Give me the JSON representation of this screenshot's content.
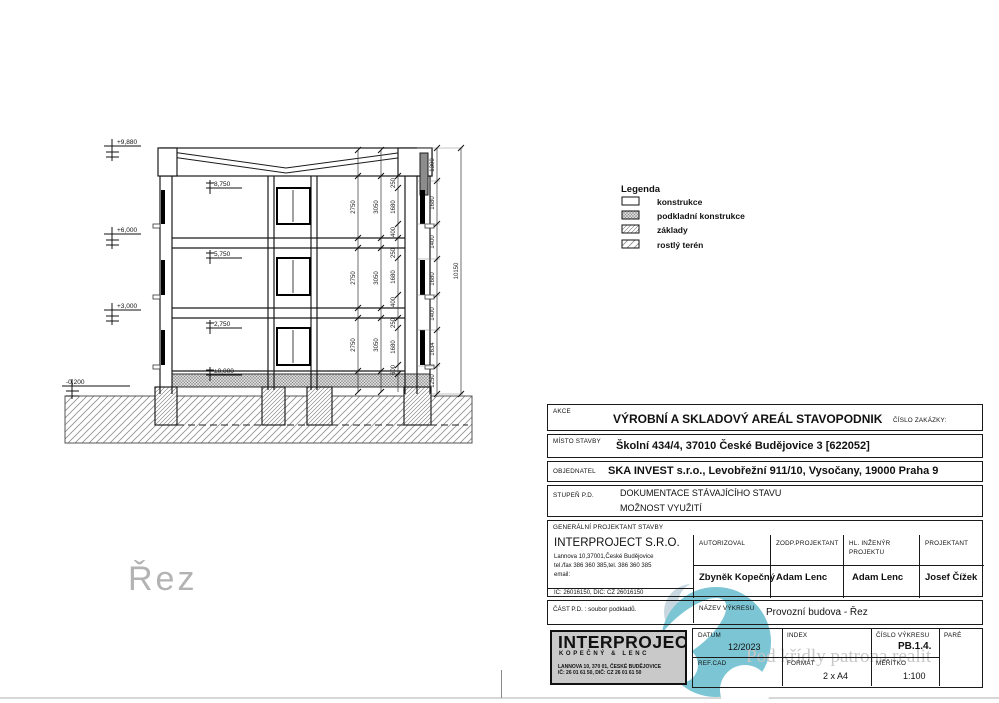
{
  "drawing": {
    "watermark": "Řez",
    "elev": [
      "+9,880",
      "+6,000",
      "+3,000",
      "-0,200"
    ],
    "levels": [
      "8,750",
      "5,750",
      "2,750",
      "±0,000"
    ],
    "dims": {
      "a": [
        "2750",
        "2750",
        "2750"
      ],
      "b": [
        "3050",
        "3050",
        "3050"
      ],
      "c": [
        "250",
        "1680",
        "400",
        "250",
        "1680",
        "400",
        "250",
        "1680",
        "600"
      ],
      "d": [
        "1300",
        "1680",
        "1400",
        "1680",
        "1400",
        "1634",
        "1250"
      ],
      "total": "10150"
    }
  },
  "legend": {
    "title": "Legenda",
    "items": [
      {
        "label": "konstrukce",
        "swatch": "plain"
      },
      {
        "label": "podkladní konstrukce",
        "swatch": "dense-hatch"
      },
      {
        "label": "základy",
        "swatch": "fine-hatch"
      },
      {
        "label": "rostlý terén",
        "swatch": "ground-hatch"
      }
    ]
  },
  "titleblock": {
    "akce_label": "AKCE",
    "akce_value": "VÝROBNÍ A SKLADOVÝ AREÁL STAVOPODNIK",
    "cislo_zakazky_label": "ČÍSLO ZAKÁZKY:",
    "misto_label": "MÍSTO STAVBY",
    "misto_value": "Školní 434/4, 37010 České Budějovice 3 [622052]",
    "objednatel_label": "OBJEDNATEL",
    "objednatel_value": "SKA INVEST s.r.o., Levobřežní 911/10, Vysočany, 19000 Praha 9",
    "stupen_label": "STUPEŇ P.D.",
    "stupen_value1": "DOKUMENTACE STÁVAJÍCÍHO STAVU",
    "stupen_value2": "MOŽNOST VYUŽITÍ",
    "gp_label": "GENERÁLNÍ PROJEKTANT STAVBY",
    "company": {
      "name": "INTERPROJECT S.R.O.",
      "addr1": "Lannova 10,37001,České Budějovice",
      "addr2": "tel./fax 386 360 385,tel. 386 360 385",
      "addr3": "email:",
      "addr4": "IČ: 26016150, DIČ: CZ 26016150"
    },
    "people": {
      "autorizoval_label": "AUTORIZOVAL",
      "autorizoval": "Zbyněk Kopečný",
      "zodp_label": "ZODP.PROJEKTANT",
      "zodp": "Adam Lenc",
      "hl_label1": "HL. INŽENÝR",
      "hl_label2": "PROJEKTU",
      "hl": "Adam Lenc",
      "proj_label": "PROJEKTANT",
      "proj": "Josef Čížek"
    },
    "cast_label": "ČÁST P.D. : soubor podkladů.",
    "nazev_label": "NÁZEV VÝKRESU",
    "nazev_value": "Provozní budova - Řez",
    "logo": {
      "line1": "INTERPROJECT",
      "line2": "KOPEČNÝ & LENC",
      "line3": "LANNOVA 10, 370 01, ČESKÉ BUDĚJOVICE",
      "line4": "IČ: 26 01 61 50,      DIČ: CZ 26 01 61 50"
    },
    "datum_label": "DATUM",
    "datum_value": "12/2023",
    "index_label": "INDEX",
    "cislo_vykresu_label": "ČÍSLO VÝKRESU",
    "cislo_vykresu_value": "PB.1.4.",
    "pare_label": "PARÉ",
    "refcad_label": "REF.CAD",
    "format_label": "FORMÁT",
    "format_value": "2 x A4",
    "meritko_label": "MĚŘÍTKO",
    "meritko_value": "1:100"
  },
  "watermark_text": "Pod křídly patrona realit",
  "colors": {
    "teal": "#7cc5d4",
    "teal_light": "#c9d8e0",
    "logo_bg": "#c9c9c9",
    "line": "#1a1a1a",
    "watermark_gray": "#c7c7c7"
  }
}
